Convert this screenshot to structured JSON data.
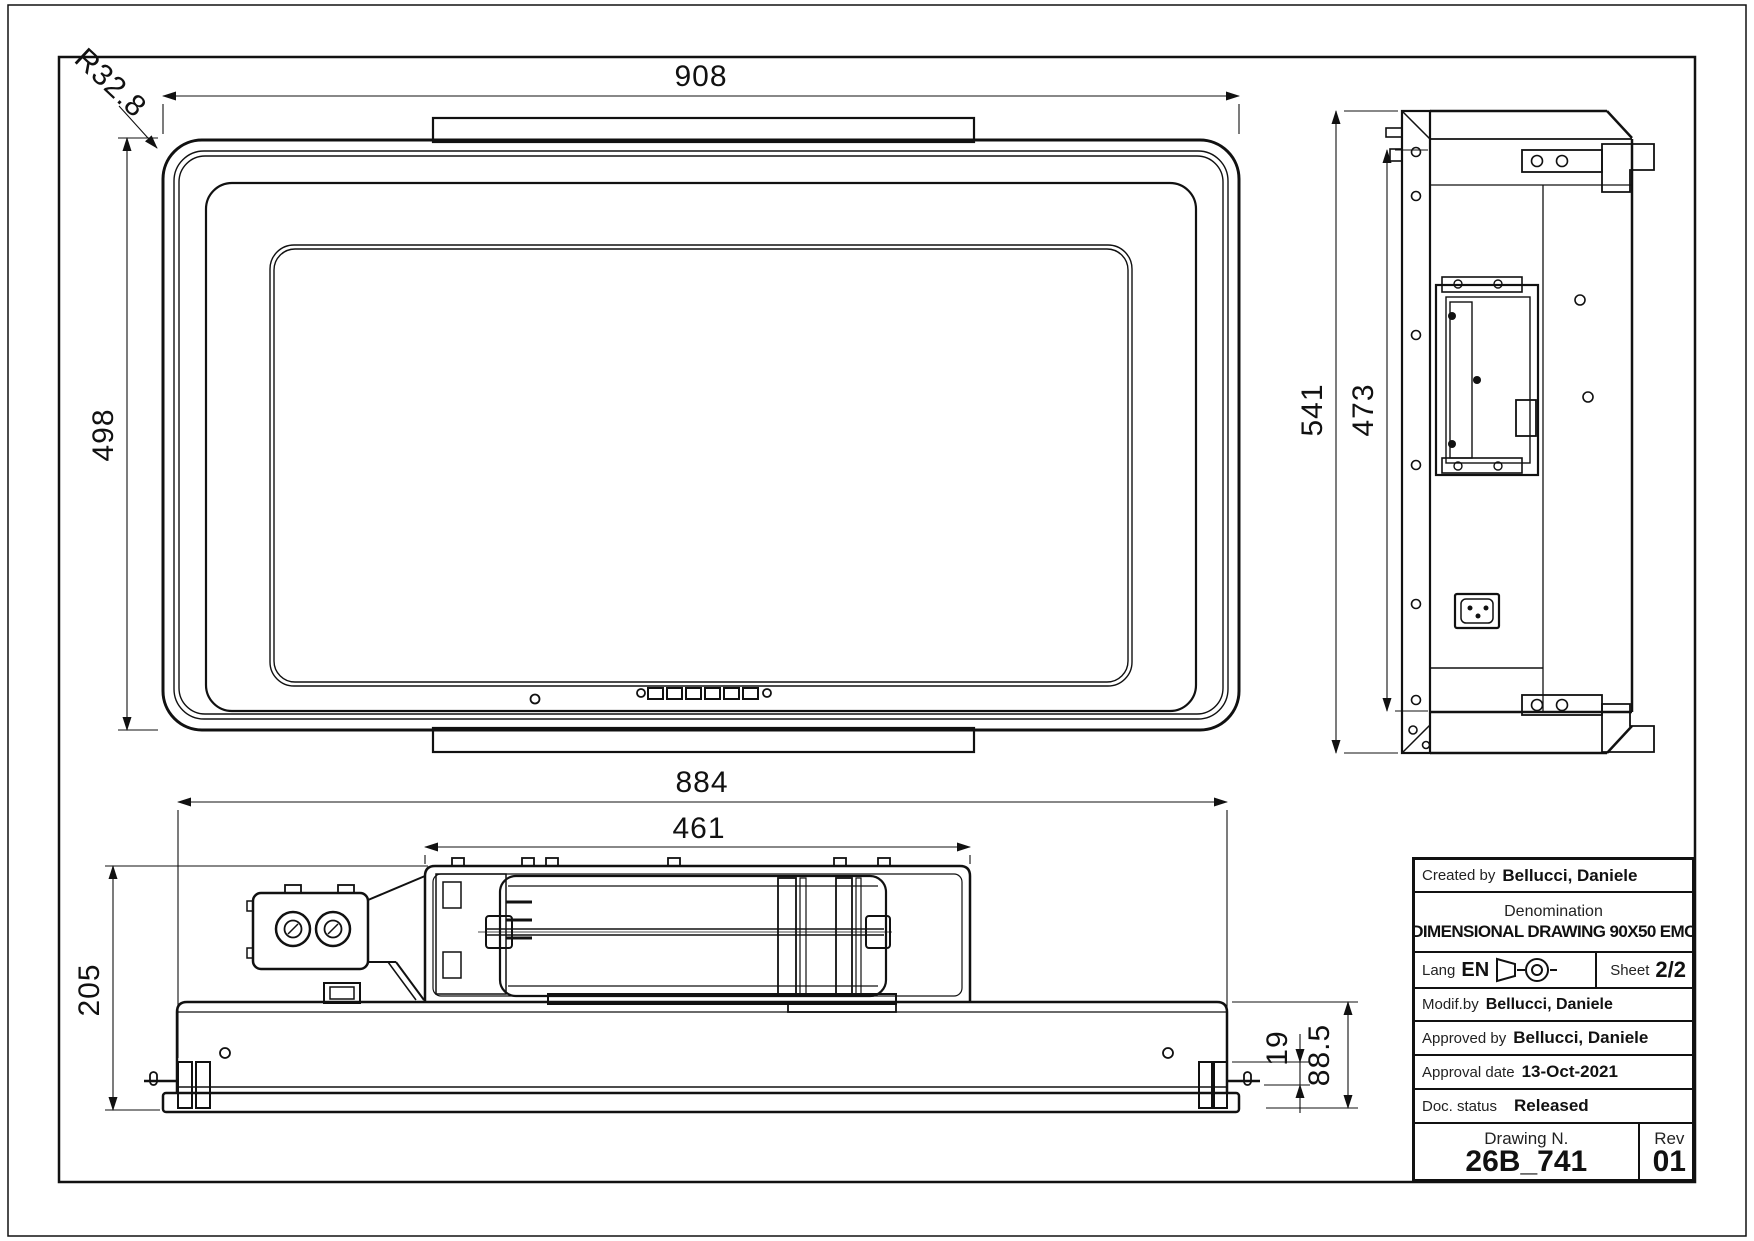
{
  "drawing": {
    "dims": {
      "top_width": "908",
      "top_height": "498",
      "corner_radius": "R32.8",
      "side_height_outer": "541",
      "side_height_inner": "473",
      "front_width_outer": "884",
      "front_motor_width": "461",
      "front_height_total": "205",
      "front_foot_offset": "19",
      "front_body_height": "88.5"
    },
    "title_block": {
      "created_by_label": "Created by",
      "created_by": "Bellucci, Daniele",
      "denomination_label": "Denomination",
      "denomination": "DIMENSIONAL DRAWING 90X50 EMC",
      "lang_label": "Lang",
      "lang": "EN",
      "sheet_label": "Sheet",
      "sheet": "2/2",
      "modified_by_label": "Modif.by",
      "modified_by": "Bellucci, Daniele",
      "approved_by_label": "Approved by",
      "approved_by": "Bellucci, Daniele",
      "approval_date_label": "Approval date",
      "approval_date": "13-Oct-2021",
      "doc_status_label": "Doc. status",
      "doc_status": "Released",
      "drawing_n_label": "Drawing N.",
      "drawing_n": "26B_741",
      "rev_label": "Rev",
      "rev": "01"
    },
    "colors": {
      "line": "#111111",
      "background": "#ffffff"
    }
  }
}
